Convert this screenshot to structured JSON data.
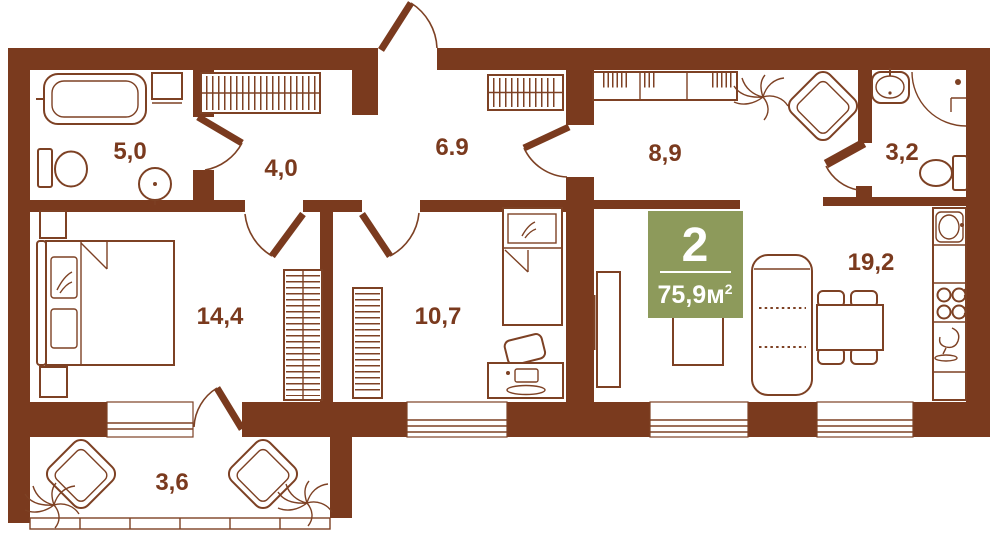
{
  "colors": {
    "wall": "#7a3a1e",
    "line": "#7d4124",
    "label": "#7a3a1e",
    "background": "#ffffff",
    "badge-bg": "#8d9a5b",
    "badge-text": "#ffffff"
  },
  "badge": {
    "room_count": "2",
    "area_value": "75,9",
    "area_unit": "м",
    "area_exponent": "2"
  },
  "rooms": {
    "bathroom": "5,0",
    "hallway": "4,0",
    "entry": "6.9",
    "hall": "8,9",
    "wc": "3,2",
    "bedroom": "14,4",
    "kids": "10,7",
    "living": "19,2",
    "balcony": "3,6"
  }
}
